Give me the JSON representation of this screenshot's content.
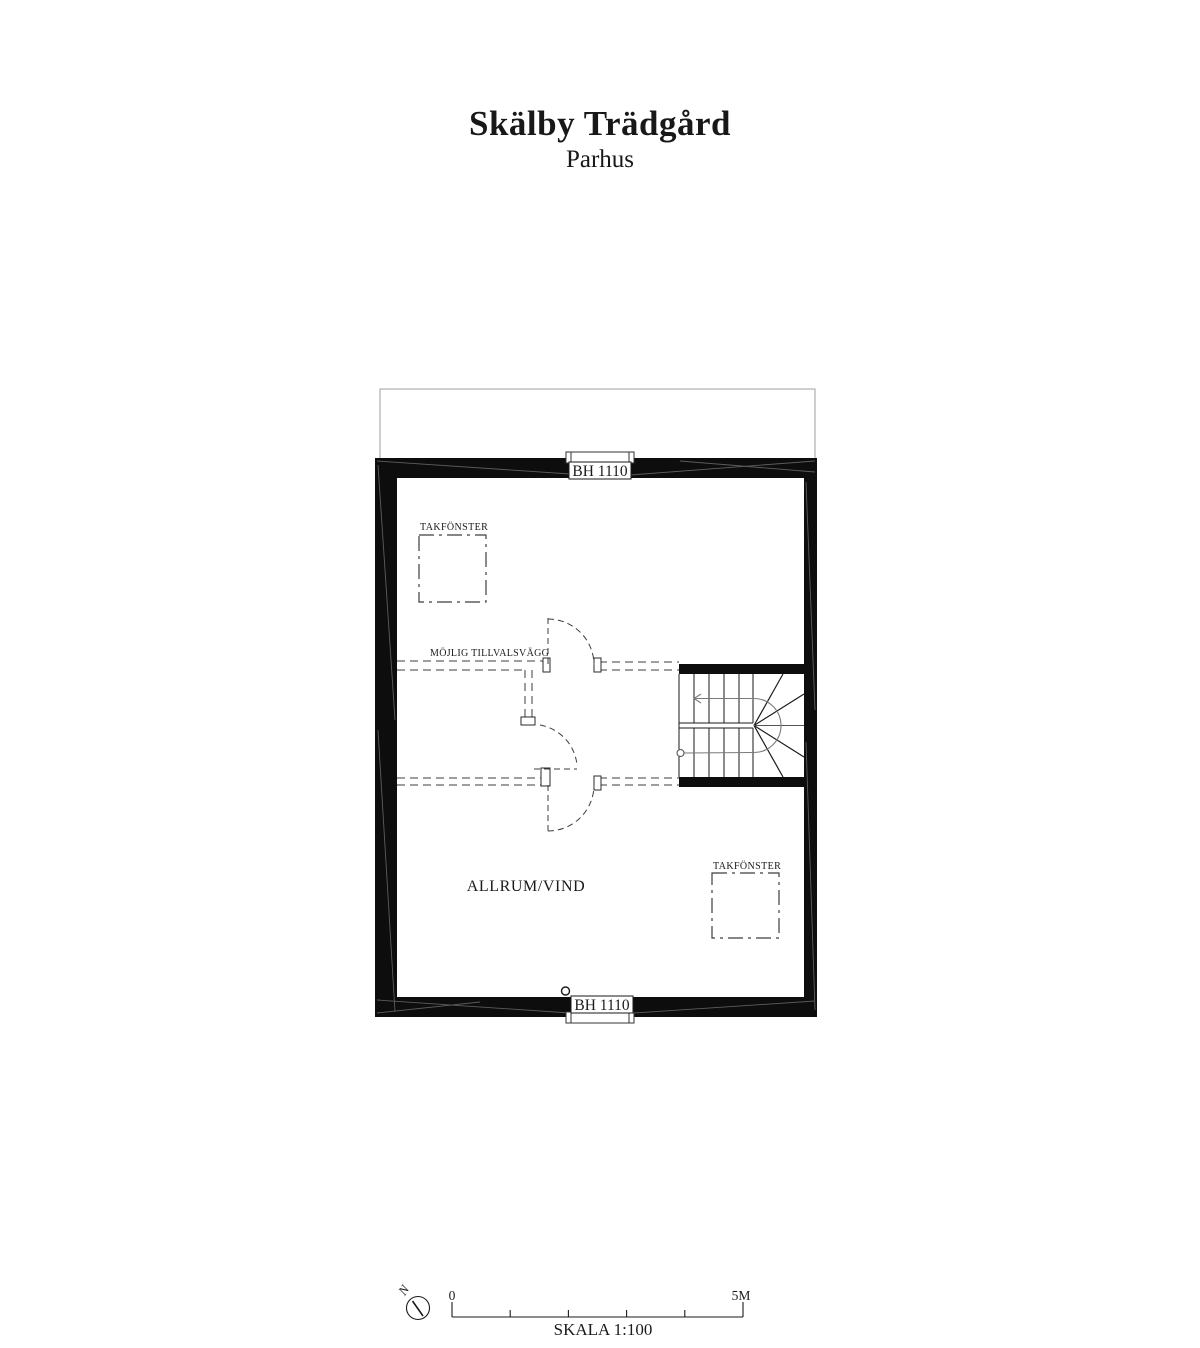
{
  "header": {
    "title": "Skälby Trädgård",
    "subtitle": "Parhus"
  },
  "plan": {
    "window_top_label": "BH 1110",
    "window_bottom_label": "BH 1110",
    "roof_window_left_label": "TAKFÖNSTER",
    "roof_window_right_label": "TAKFÖNSTER",
    "optional_wall_label": "MÖJLIG TILLVALSVÄGG",
    "room_label": "ALLRUM/VIND"
  },
  "scale_bar": {
    "north_label": "N",
    "zero_label": "0",
    "max_label": "5M",
    "scale_label": "SKALA 1:100"
  },
  "colors": {
    "ink": "#1a1a1a",
    "wall": "#0d0d0d",
    "roof_outline": "#b3b3b3",
    "walk_line": "#7a7a7a",
    "dashed_line": "#3d3d3d"
  }
}
